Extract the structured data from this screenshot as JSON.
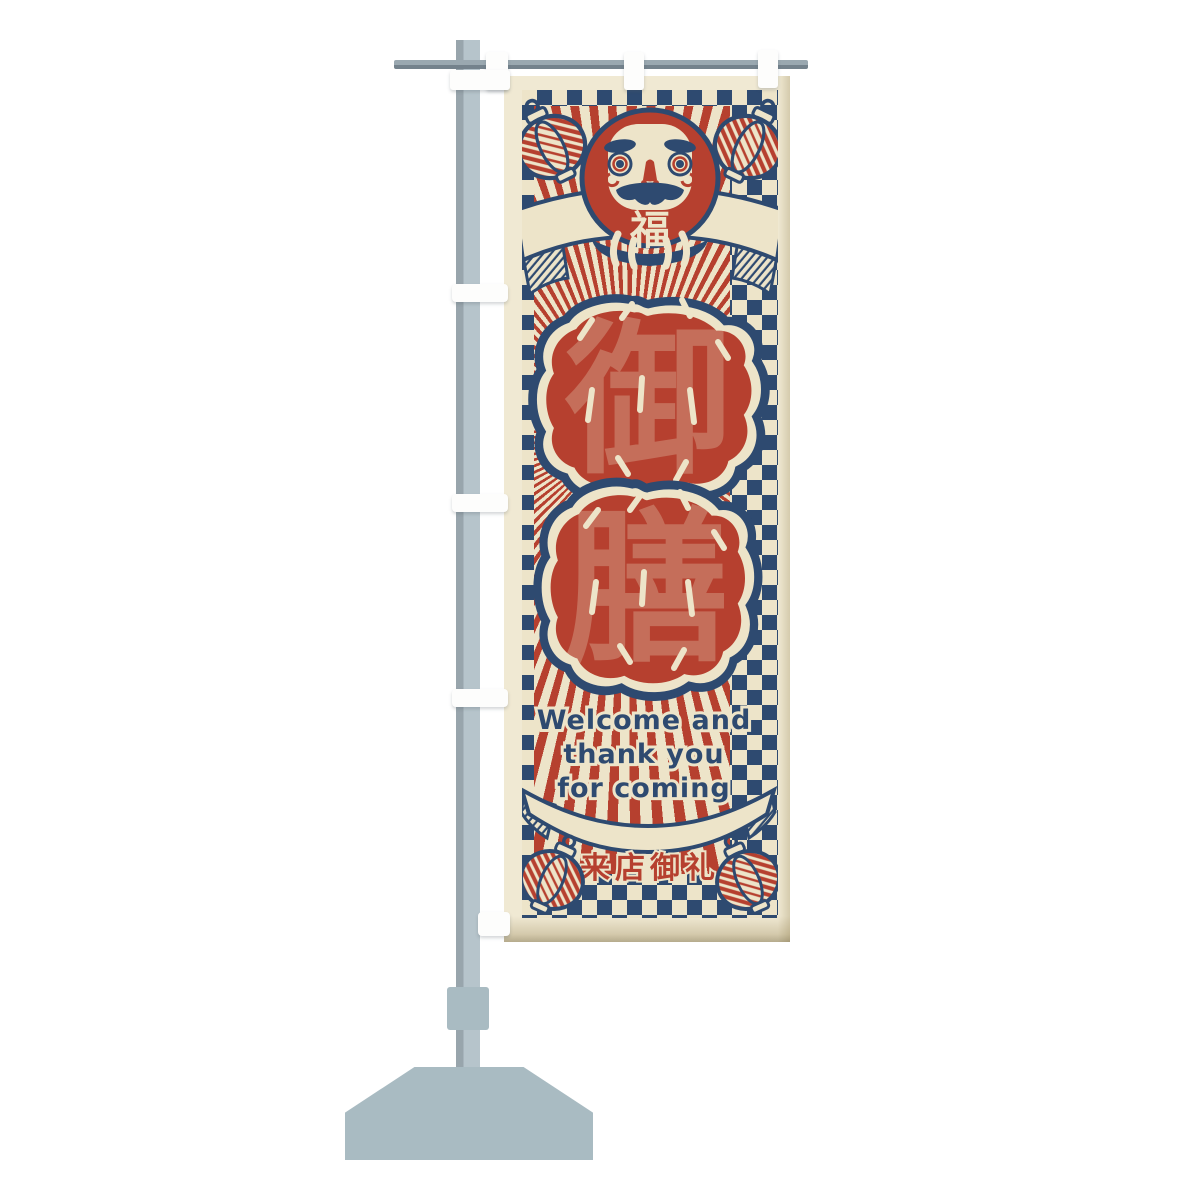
{
  "banner": {
    "daruma": {
      "belly_character": "福"
    },
    "title": {
      "text": "御膳",
      "characters": [
        "御",
        "膳"
      ]
    },
    "message_lines": [
      "Welcome and",
      "thank you",
      "for coming"
    ],
    "footer_ribbon_text": "来店御礼",
    "colors": {
      "cloth_cream": "#F0E9D3",
      "print_cream": "#EDE4C9",
      "accent_red": "#B6402F",
      "navy": "#2E4A70"
    },
    "icons": [
      "daruma-icon",
      "paper-lantern-icon",
      "ribbon-banner-icon",
      "sunburst-icon",
      "checker-border-icon"
    ]
  },
  "stand": {
    "colors": {
      "pole_gray": "#B6C4CB",
      "pole_shade_gray": "#98A5AC",
      "crossbar_gray": "#74828C",
      "base_gray": "#A9BBC2",
      "clip_white": "#FDFDFC"
    }
  }
}
